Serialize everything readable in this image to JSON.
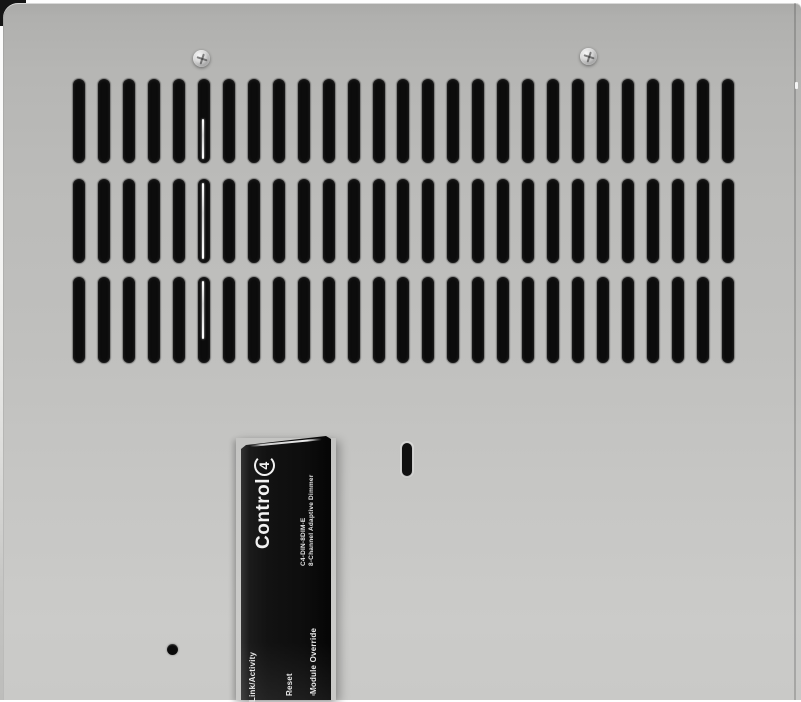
{
  "device": {
    "brand": "Control",
    "brand_numeral": "4",
    "model": "C4-DIN-8DIM-E",
    "model_description": "8-Channel Adaptive Dimmer",
    "labels": {
      "link_activity": "Link/Activity",
      "reset": "Reset",
      "module_override": "Module Override"
    }
  },
  "panel": {
    "vent_rows": 3,
    "vent_columns": 27,
    "highlight_column": 5,
    "screw_count": 2,
    "colors": {
      "panel_metal": "#bcbcba",
      "vent_slot": "#0c0c0c",
      "label_strip": "#0d0d0d",
      "strip_text": "#eaeaea",
      "background": "#f7f7f7"
    }
  }
}
